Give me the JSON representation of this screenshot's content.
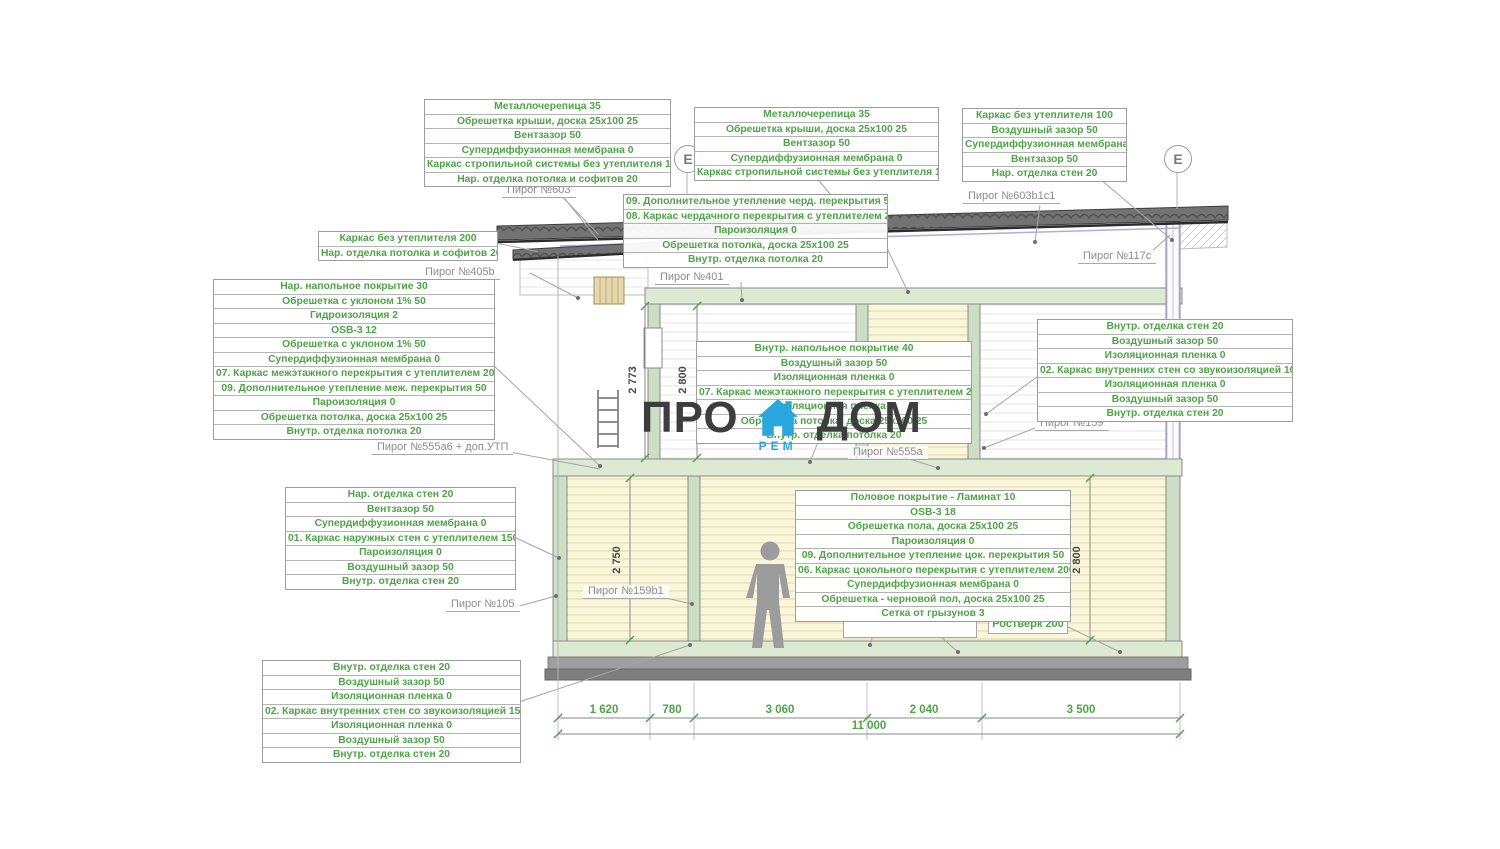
{
  "logo": {
    "part1": "ПРО",
    "part2": "ДОМ",
    "sub": "РЕМ",
    "text_color": "#3d3d3f",
    "accent_color": "#2aa7dd"
  },
  "grid_markers": {
    "left": "Е",
    "right": "Е"
  },
  "colors": {
    "callout_text": "#4ea446",
    "leader": "#a5a5a5",
    "slab_fill": "#dce9d3",
    "wall_fill": "#ccdfc4",
    "room_fill": "#f9f6da",
    "roof_fill": "#737373"
  },
  "callouts": {
    "roof_left": [
      "Металлочерепица 35",
      "Обрешетка крыши, доска 25х100 25",
      "Вентзазор 50",
      "Супердиффузионная мембрана 0",
      "Каркас стропильной системы без утеплителя 150",
      "Нар. отделка потолка и софитов 20"
    ],
    "roof_mid": [
      "Металлочерепица 35",
      "Обрешетка крыши, доска 25х100 25",
      "Вентзазор 50",
      "Супердиффузионная мембрана 0",
      "Каркас стропильной системы без утеплителя 150"
    ],
    "wall_top_right": [
      "Каркас без утеплителя 100",
      "Воздушный зазор 50",
      "Супердиффузионная мембрана 0",
      "Вентзазор 50",
      "Нар. отделка стен 20"
    ],
    "attic": [
      "09. Дополнительное утепление черд. перекрытия 50",
      "08. Каркас чердачного перекрытия с утеплителем 200",
      "Пароизоляция 0",
      "Обрешетка потолка, доска 25х100 25",
      "Внутр. отделка потолка 20"
    ],
    "eaves_left": [
      "Каркас без утеплителя 200",
      "Нар. отделка потолка и софитов 20"
    ],
    "interfloor_left": [
      "Нар. напольное покрытие 30",
      "Обрешетка с уклоном 1% 50",
      "Гидроизоляция 2",
      "OSB-3 12",
      "Обрешетка с уклоном 1% 50",
      "Супердиффузионная мембрана 0",
      "07. Каркас межэтажного перекрытия с утеплителем 200",
      "09. Дополнительное утепление меж. перекрытия 50",
      "Пароизоляция 0",
      "Обрешетка потолка, доска 25х100 25",
      "Внутр. отделка потолка 20"
    ],
    "interfloor_center": [
      "Внутр. напольное покрытие 40",
      "Воздушный зазор 50",
      "Изоляционная пленка 0",
      "07. Каркас межэтажного перекрытия с утеплителем 200",
      "Изоляционная пленка 0",
      "Обрешетка потолка, доска 25х100 25",
      "Внутр. отделка потолка 20"
    ],
    "interior_wall_right": [
      "Внутр. отделка стен 20",
      "Воздушный зазор 50",
      "Изоляционная пленка 0",
      "02. Каркас внутренних стен со звукоизоляцией 100",
      "Изоляционная пленка 0",
      "Воздушный зазор 50",
      "Внутр. отделка стен 20"
    ],
    "exterior_wall_left": [
      "Нар. отделка стен 20",
      "Вентзазор 50",
      "Супердиффузионная мембрана 0",
      "01. Каркас наружных стен с утеплителем 150",
      "Пароизоляция 0",
      "Воздушный зазор 50",
      "Внутр. отделка стен 20"
    ],
    "ground_floor": [
      "Половое покрытие - Ламинат 10",
      "OSB-3 18",
      "Обрешетка пола, доска 25х100 25",
      "Пароизоляция 0",
      "09. Дополнительное утепление цок. перекрытия 50",
      "06. Каркас цокольного перекрытия с утеплителем 200",
      "Супердиффузионная мембрана 0",
      "Обрешетка - черновой пол, доска 25х100 25",
      "Сетка от грызунов 3"
    ],
    "interior_wall_ground": [
      "Внутр. отделка стен 20",
      "Воздушный зазор 50",
      "Изоляционная пленка 0",
      "02. Каркас внутренних стен со звукоизоляцией 150",
      "Изоляционная пленка 0",
      "Воздушный зазор 50",
      "Внутр. отделка стен 20"
    ]
  },
  "pie_labels": {
    "p603": "Пирог №603",
    "p603b1c1": "Пирог №603b1c1",
    "p405b": "Пирог №405b",
    "p401": "Пирог №401",
    "p117c": "Пирог №117c",
    "p555a6": "Пирог №555а6 + доп.УТП",
    "p555a": "Пирог №555a",
    "p159": "Пирог №159",
    "p159b1": "Пирог №159b1",
    "p105": "Пирог №105",
    "p305c": "Пирог №305c",
    "rostverk": "Ростверк 200"
  },
  "dimensions": {
    "bottom": [
      "1 620",
      "780",
      "3 060",
      "2 040",
      "3 500"
    ],
    "total": "11 000",
    "floor2_left": "2 773",
    "floor2_right": "2 800",
    "floor1_left": "2 750",
    "floor1_right": "2 800"
  }
}
